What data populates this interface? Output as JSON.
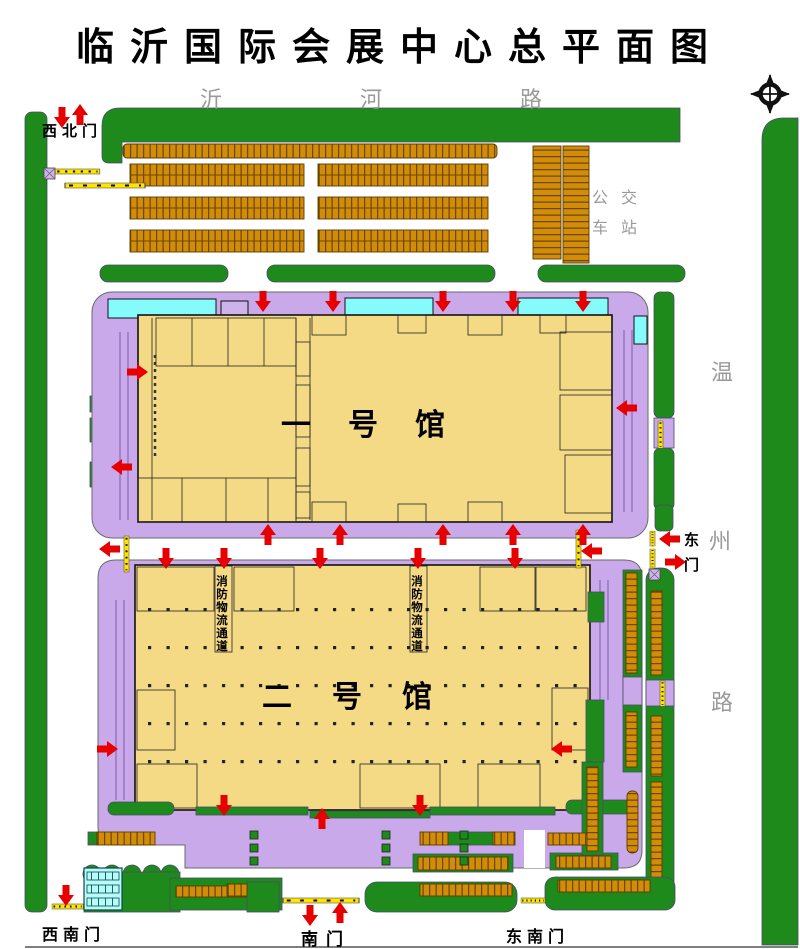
{
  "title": "临沂国际会展中心总平面图",
  "roads": {
    "north": "沂河路",
    "east_chars": [
      "温",
      "州",
      "路"
    ]
  },
  "gates": {
    "northwest": "西北门",
    "east": "东门",
    "south": "南门",
    "southwest": "西南门",
    "southeast": "东南门"
  },
  "labels": {
    "bus_station": "公交车站",
    "hall1": "一号馆",
    "hall2": "二号馆",
    "fire_lane": "消防物流通道"
  },
  "icons": {
    "compass": "north-compass",
    "arrow": "entrance-direction-arrow",
    "barrier": "gate-barrier",
    "gate_post": "gate-post"
  },
  "colors": {
    "green": "#1e8a1c",
    "parking_orange": "#d28c0a",
    "apron_purple": "#c9a9e9",
    "hall_yellow": "#f5da85",
    "canopy_cyan": "#86fbfb",
    "arrow_red": "#e60000",
    "barrier_yellow": "#ffe400",
    "road_text_gray": "#9a9a9a"
  }
}
